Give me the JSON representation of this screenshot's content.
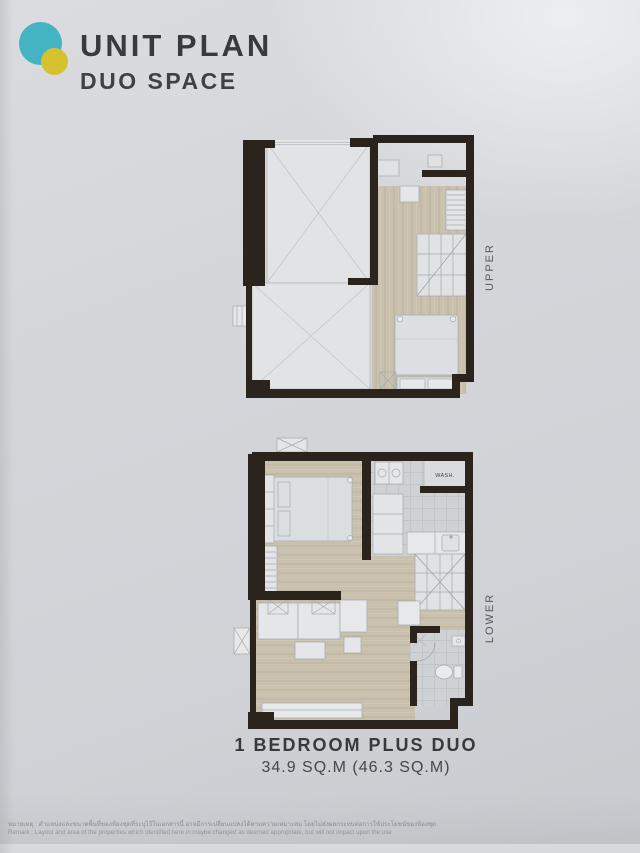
{
  "header": {
    "title": "UNIT PLAN",
    "subtitle": "DUO SPACE"
  },
  "plans": {
    "upper": {
      "label": "UPPER"
    },
    "lower": {
      "label": "LOWER",
      "wash_label": "WASH."
    }
  },
  "footer": {
    "unit_name": "1 BEDROOM PLUS DUO",
    "unit_area": "34.9 SQ.M (46.3 SQ.M)"
  },
  "remark": {
    "thai": "หมายเหตุ : ตำแหน่งและขนาดพื้นที่ของห้องชุดที่ระบุไว้ในเอกสารนี้ อาจมีการเปลี่ยนแปลงได้ตามความเหมาะสม โดยไม่ส่งผลกระทบต่อการใช้ประโยชน์ของห้องชุด",
    "english": "Remark : Layout and area of the properties which identified here in maybe changed as deemed appropriate, but will not impact upon the use"
  },
  "colors": {
    "logo_teal": "#45b4c2",
    "logo_yellow": "#d6c22f",
    "wall": "#2b241d",
    "wood": "#c9c0ad",
    "tile": "#ced2d4",
    "title_text": "#3a3a3c"
  }
}
